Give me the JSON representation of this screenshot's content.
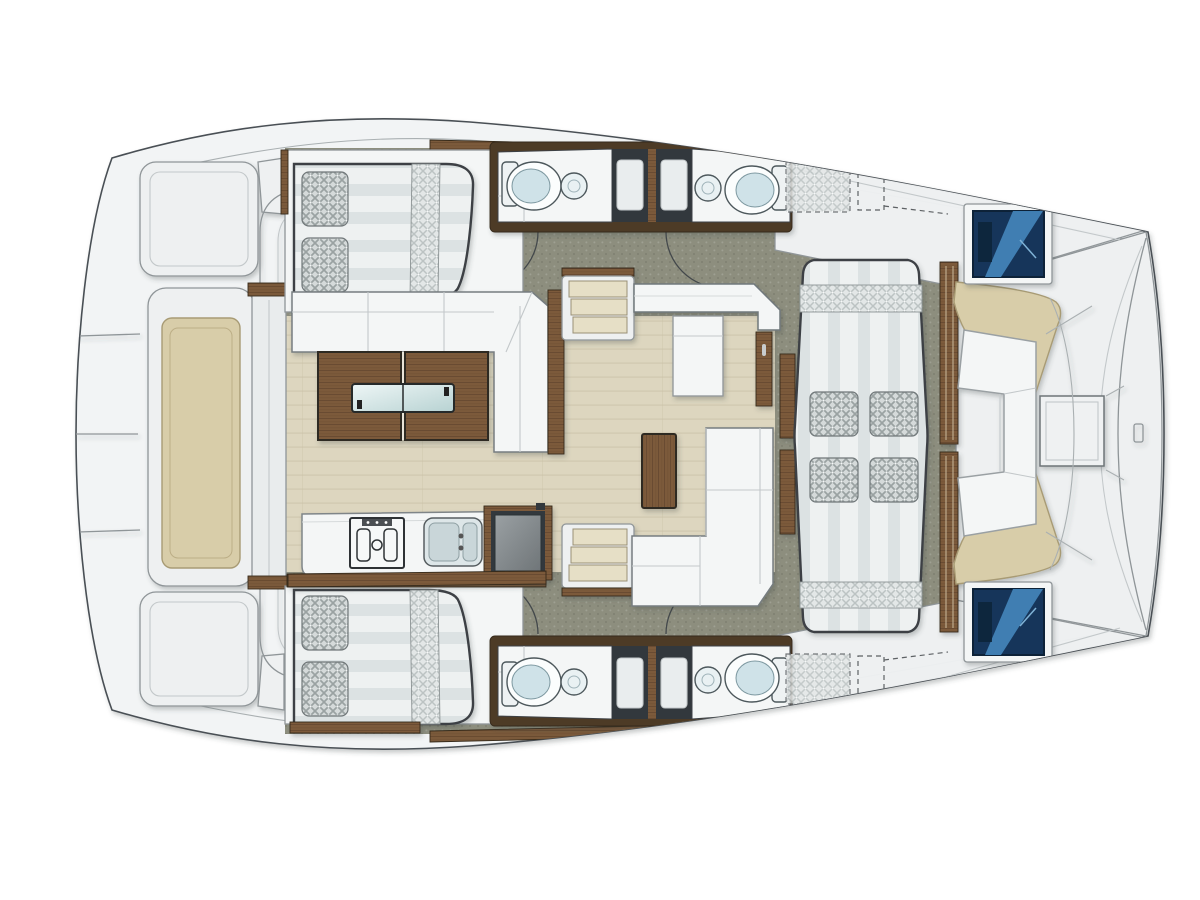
{
  "meta": {
    "title": "Catamaran deck and accommodation plan",
    "orientation": "bow-right, top-down view"
  },
  "colors": {
    "background": "#ffffff",
    "outline": "#4a5054",
    "hull": "#f2f4f5",
    "hullEdge": "#6d7478",
    "greyMid": "#8f9598",
    "greyLine": "#c3c8ca",
    "deck": "#8d8e7e",
    "floor": "#ddd6bf",
    "floorLine": "#c9c1a6",
    "wood": "#7b5a3b",
    "woodGrain": "#66492e",
    "woodDark": "#4e3a26",
    "woodEdge": "#362a1a",
    "white": "#f4f6f6",
    "bedBase": "#eef1f1",
    "bedStripe": "#dce2e3",
    "bedOutline": "#3c4144",
    "weaveBg": "#d5dada",
    "weave": "#9aa2a2",
    "weaveLightBg": "#e3e7e7",
    "weaveLight": "#bcc3c3",
    "showerDark": "#32383c",
    "tray": "#e9edee",
    "porcelain": "#fbfdfd",
    "aqua": "#cfe2e8",
    "fixtureOutline": "#4d585c",
    "glassA": "#eef6f6",
    "glassB": "#b7d2d2",
    "navy": "#16365a",
    "navyDeep": "#0d2238",
    "blueLight": "#4183b7",
    "beige": "#d8cda9",
    "beigeEdge": "#a89b74",
    "stepTread": "#e6dfc6",
    "stepEdge": "#9a9076",
    "applA": "#9aa0a3",
    "applB": "#6f7578",
    "arc": "#43484b",
    "dash": "#5d6164"
  },
  "labels": {
    "plan": "catamaran interior and deck plan",
    "hull": "catamaran hull outline",
    "aftPlatform": "aft platform and transom steps",
    "tenderPad": "tender chock pad",
    "aftDoor": "salon aft sliding door",
    "aftCabinTop": "aft double cabin, port hull",
    "aftCabinBottom": "aft double cabin, starboard hull",
    "berth": "double berth with pillows",
    "bathroomTopLeft": "bathroom with shower, port hull aft",
    "bathroomTopRight": "bathroom with shower, port hull forward",
    "bathroomBottomLeft": "bathroom with shower, starboard hull aft",
    "bathroomBottomRight": "bathroom with shower, starboard hull forward",
    "shower": "shower cabin",
    "toilet": "toilet",
    "washbasin": "washbasin",
    "doorSwing": "cabin door swing",
    "salon": "salon with dinette",
    "dinetteSofa": "dinette L-shaped settee",
    "diningTable": "wooden dining table with glass inserts",
    "galley": "galley counter",
    "stove": "stove top",
    "galleySink": "double galley sink",
    "fridge": "top-loading fridge",
    "stepsTop": "companionway steps to port hull",
    "stepsBottom": "companionway steps to starboard hull",
    "navCounter": "forward chart counter",
    "loungeSofa": "salon lounge L-settee",
    "coffeeTable": "coffee table",
    "sunbed": "forward cockpit sunbed",
    "slats": "teak step slats",
    "bowSettee": "forward cockpit U-settee",
    "bowTable": "forward cockpit table",
    "bowCushionTop": "forward sunbathing cushion, port",
    "bowCushionBottom": "forward sunbathing cushion, starboard",
    "hatchTop": "deck hatch window, port bow",
    "hatchBottom": "deck hatch window, starboard bow",
    "foredeckTop": "port foredeck",
    "foredeckBottom": "starboard foredeck",
    "hiddenBerthTop": "forward berth below deck (dashed)",
    "hiddenBerthBottom": "forward berth below deck (dashed)",
    "bowBeam": "forward crossbeam"
  }
}
